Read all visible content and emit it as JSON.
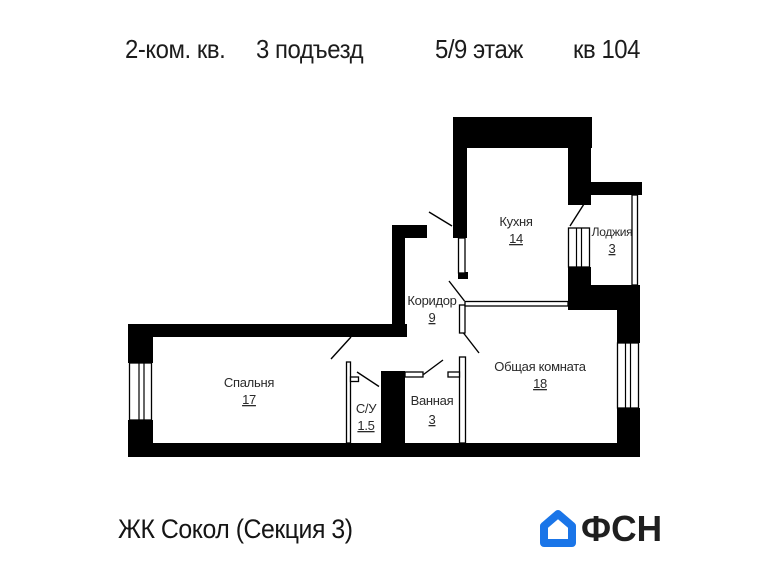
{
  "header": {
    "apartment_type": "2-ком. кв.",
    "entrance": "3 подъезд",
    "floor": "5/9 этаж",
    "unit": "кв 104"
  },
  "rooms": [
    {
      "name": "Кухня",
      "area": "14"
    },
    {
      "name": "Лоджия",
      "area": "3"
    },
    {
      "name": "Коридор",
      "area": "9"
    },
    {
      "name": "Общая комната",
      "area": "18"
    },
    {
      "name": "Спальня",
      "area": "17"
    },
    {
      "name": "С/У",
      "area": "1.5"
    },
    {
      "name": "Ванная",
      "area": "3"
    }
  ],
  "footer": {
    "project": "ЖК Сокол (Секция 3)",
    "logo_text": "ФСН"
  },
  "colors": {
    "wall": "#000000",
    "logo_blue": "#1a75e8",
    "text": "#1c1c1c"
  }
}
